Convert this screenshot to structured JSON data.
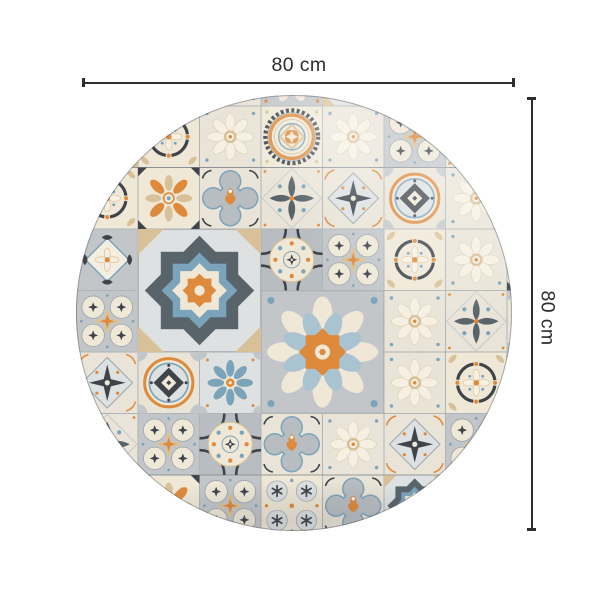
{
  "dimensions": {
    "width": {
      "label": "80 cm",
      "value": 80,
      "unit": "cm"
    },
    "height": {
      "label": "80 cm",
      "value": 80,
      "unit": "cm"
    }
  },
  "palette": {
    "ink": "#2d2d2d",
    "dark": "#3e444a",
    "slate": "#59636a",
    "steel": "#9aa5ab",
    "gray": "#c2c6c9",
    "gray2": "#b7bdc1",
    "lightgray": "#dde1e2",
    "cream": "#efe8d7",
    "cream2": "#e9e4d7",
    "tan": "#d8c198",
    "blue": "#7ba3ba",
    "lightblue": "#a9c3d1",
    "orange": "#dd8a3d",
    "seam": "#b0b4b6",
    "edge": "#6f777d",
    "background": "#ffffff"
  },
  "rug": {
    "shape": "circle",
    "motifs": [
      "medallion",
      "quatrefoil",
      "sunburst",
      "sunburst2",
      "octastar",
      "diamond-curl",
      "diamond-star",
      "arc-circle",
      "cross-petal",
      "four-rings",
      "blue-flower",
      "orange-cross",
      "ring-diamond",
      "circle-dots",
      "snowflake",
      "daisy"
    ],
    "pattern_grid": [
      [
        "cross-petal",
        "four-rings",
        "blue-flower",
        "daisy",
        "sunburst2",
        "octastar",
        "arc-circle",
        "diamond-curl",
        "orange-cross"
      ],
      [
        "snowflake",
        "octastar",
        "arc-circle",
        "daisy",
        "medallion",
        "daisy",
        "four-rings",
        "cross-petal",
        "blue-flower"
      ],
      [
        "blue-flower",
        "arc-circle",
        "orange-cross",
        "quatrefoil",
        "cross-petal",
        "diamond-star",
        "ring-diamond",
        "daisy",
        "snowflake"
      ],
      [
        "daisy",
        "diamond-curl",
        "",
        "",
        "circle-dots",
        "four-rings",
        "arc-circle",
        "daisy",
        "orange-cross"
      ],
      [
        "octastar",
        "four-rings",
        "",
        "",
        "",
        "",
        "daisy",
        "cross-petal",
        "ring-diamond"
      ],
      [
        "four-rings",
        "diamond-star",
        "ring-diamond",
        "blue-flower",
        "",
        "",
        "daisy",
        "arc-circle",
        "cross-petal"
      ],
      [
        "arc-circle",
        "cross-petal",
        "four-rings",
        "circle-dots",
        "quatrefoil",
        "daisy",
        "diamond-star",
        "four-rings",
        "blue-flower"
      ],
      [
        "diamond-curl",
        "blue-flower",
        "orange-cross",
        "four-rings",
        "snowflake",
        "quatrefoil",
        "octastar",
        "daisy",
        "medallion"
      ]
    ],
    "large_tiles": [
      {
        "motif": "octastar",
        "col": 2,
        "row": 3,
        "span": 2
      },
      {
        "motif": "sunburst",
        "col": 4,
        "row": 4,
        "span": 2
      }
    ]
  }
}
